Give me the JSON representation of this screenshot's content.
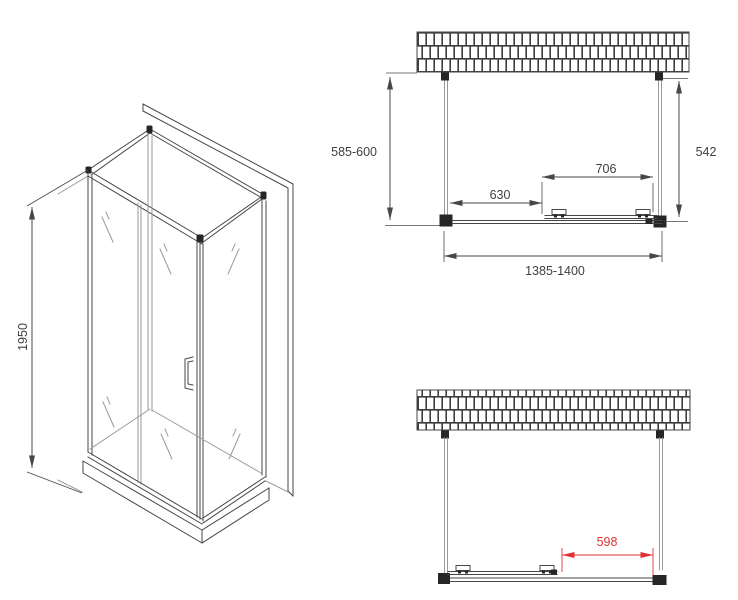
{
  "drawing": {
    "title": "shower-enclosure-technical-drawing",
    "iso_view": {
      "height_dimension": "1950"
    },
    "plan_view_closed": {
      "side_depth_dimension": "585-600",
      "right_depth_dimension": "542",
      "door_width_dimension": "706",
      "fixed_panel_dimension": "630",
      "total_width_dimension": "1385-1400"
    },
    "plan_view_open": {
      "opening_dimension": "598"
    }
  },
  "colors": {
    "line": "#474747",
    "line_light": "#9a9a9a",
    "fitting": "#262626",
    "dim_red": "#e03232",
    "text": "#3f3f3f",
    "bg": "#ffffff"
  }
}
